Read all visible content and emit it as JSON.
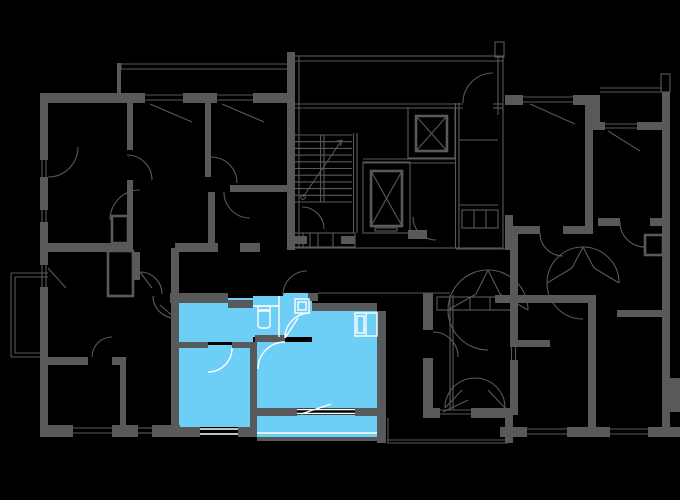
{
  "colors": {
    "background": "#000000",
    "walls": "#58595B",
    "highlight": "#6DCFF6",
    "detail": "#FFFFFF"
  },
  "plan": {
    "type": "residential-floor-plan",
    "highlighted_unit": {
      "rooms": [
        "hall",
        "bathroom",
        "entry",
        "kitchen-living-room",
        "bedroom",
        "balcony"
      ],
      "fixtures": [
        "toilet",
        "washing-machine",
        "duct-shaft"
      ]
    },
    "core": [
      "staircase",
      "elevator-1",
      "elevator-2",
      "duct-shafts",
      "landing"
    ],
    "features": [
      "door-swings",
      "windows",
      "balconies",
      "shaft-boxes"
    ]
  }
}
